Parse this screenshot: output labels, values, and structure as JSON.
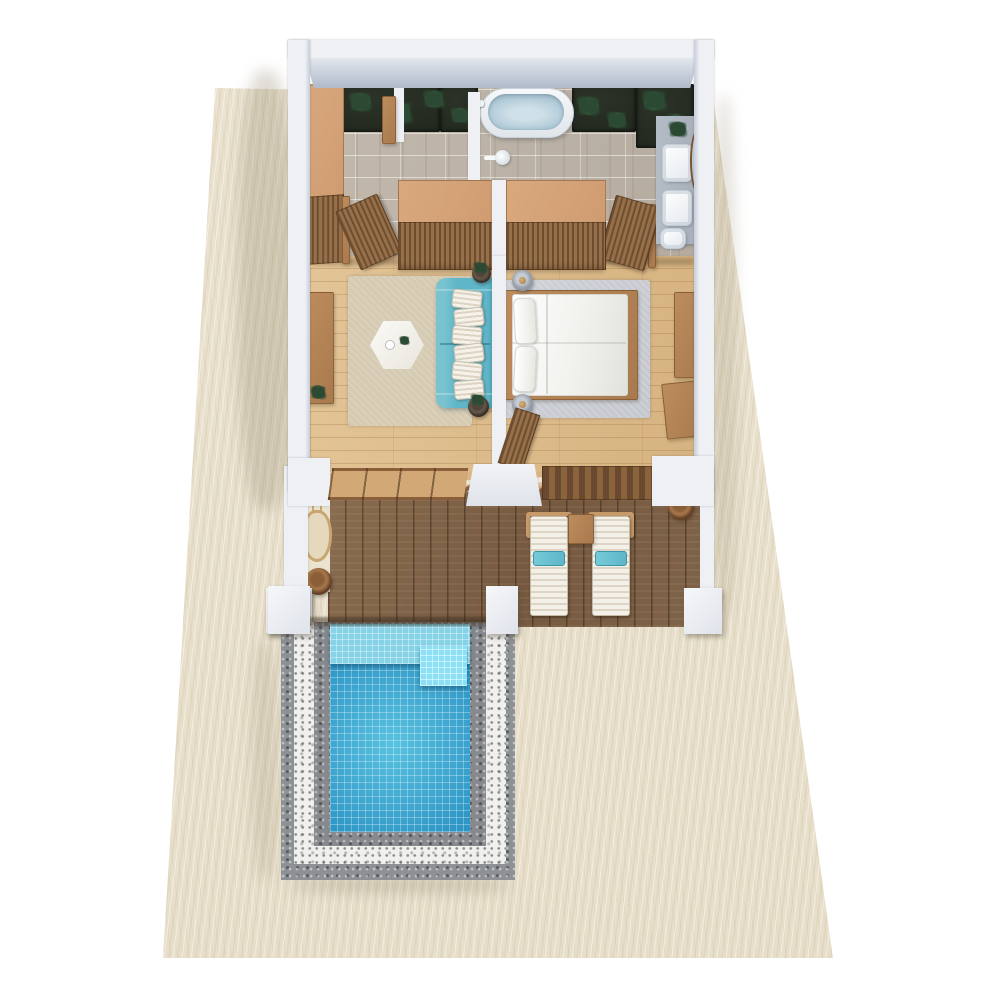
{
  "scene": {
    "description": "Top-down 3D architectural render of a one-bedroom beach pool villa",
    "areas": [
      {
        "name": "bathroom",
        "items": [
          "tall-wardrobe",
          "planters-with-plants",
          "freestanding-bathtub",
          "shower-partition",
          "shower-head",
          "vanity-counter",
          "basin",
          "basin",
          "toilet",
          "wall-mirror",
          "counter-plant",
          "open-door",
          "open-door"
        ]
      },
      {
        "name": "living-room",
        "items": [
          "built-in-closet",
          "tv-console",
          "tv",
          "area-rug",
          "hexagonal-coffee-table",
          "sofa",
          "sofa-cushions",
          "end-planters",
          "floor-plant"
        ]
      },
      {
        "name": "bedroom",
        "items": [
          "built-in-closet",
          "double-bed",
          "bed-pillows",
          "bedside-lamp",
          "bedside-lamp",
          "area-rug",
          "dressing-table",
          "dressing-mirror",
          "stool"
        ]
      },
      {
        "name": "deck",
        "items": [
          "pergola-beams",
          "hanging-chair",
          "round-pot",
          "sun-lounger",
          "sun-lounger",
          "side-table",
          "planter-pot",
          "white-pillars"
        ]
      },
      {
        "name": "pool-area",
        "items": [
          "plunge-pool",
          "underwater-bench",
          "corner-step",
          "dark-pebble-border",
          "white-pebble-border"
        ]
      },
      {
        "name": "exterior",
        "items": [
          "sand-plot"
        ]
      }
    ],
    "counts": {
      "sun_loungers": 2,
      "vanity_basins": 2,
      "bedside_lamps": 2,
      "sofa_cushions": 6,
      "bed_pillows": 2
    }
  },
  "colors": {
    "sand": "#ebe3d0",
    "wall": "#eef0f4",
    "tile": "#c2b9ac",
    "woodFloor": "#e3c496",
    "deck": "#76593f",
    "pergola": "#e0bd92",
    "closetTop": "#d9a97e",
    "closetSlatA": "#6f4e30",
    "closetSlatB": "#96704a",
    "woodMid": "#bc8c5d",
    "sofa": "#5fb6c8",
    "rugLiving": "#d5cab2",
    "rugBedroom": "#c4c7cd",
    "lampGrey": "#9aa0aa",
    "porcelain": "#f7f8fa",
    "vanity": "#a8b0bb",
    "tubWater": "#b5cdda",
    "soil": "#20261d",
    "leaf": "#4a7a4d",
    "leafDark": "#2c4a33",
    "pool": "#2f97c6",
    "poolBench": "#86d2e6",
    "pebbleWhite": "#f0f0ee",
    "pebbleGrey": "#8d9094"
  }
}
